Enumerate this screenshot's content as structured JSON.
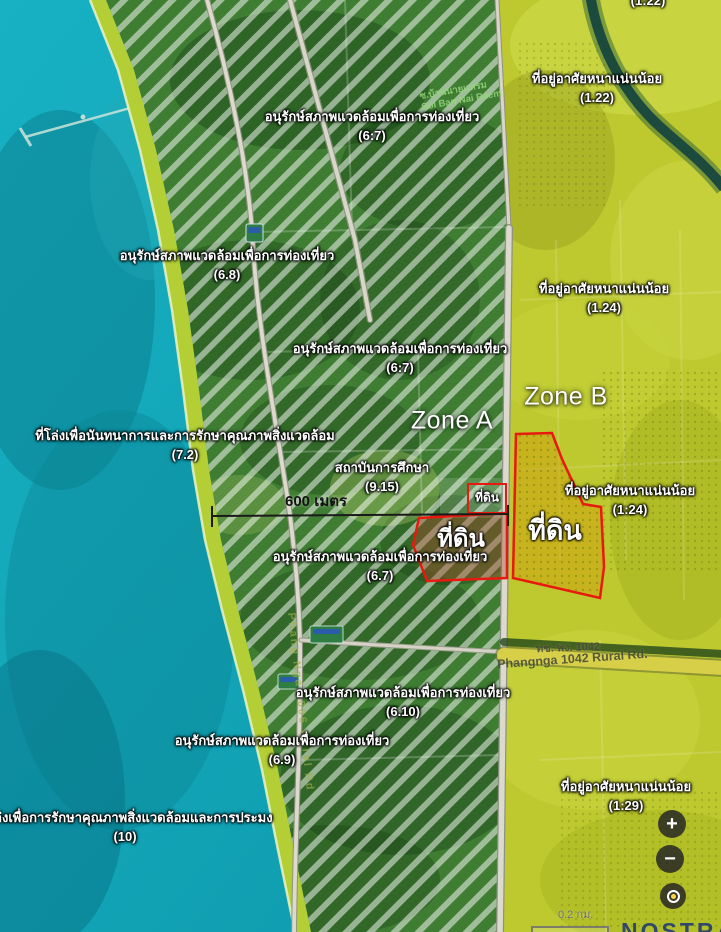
{
  "map": {
    "title_zone_a": "Zone A",
    "title_zone_b": "Zone B",
    "plot_label": "ที่ดิน",
    "measurement_label": "600 เมตร",
    "zoning_labels": [
      {
        "name": "อนุรักษ์สภาพแวดล้อมเพื่อการท่องเที่ยว",
        "code": "(6:7)"
      },
      {
        "name": "อนุรักษ์สภาพแวดล้อมเพื่อการท่องเที่ยว",
        "code": "(6.8)"
      },
      {
        "name": "อนุรักษ์สภาพแวดล้อมเพื่อการท่องเที่ยว",
        "code": "(6:7)"
      },
      {
        "name": "ที่โล่งเพื่อนันทนาการและการรักษาคุณภาพสิ่งแวดล้อม",
        "code": "(7.2)"
      },
      {
        "name": "สถาบันการศึกษา",
        "code": "(9.15)"
      },
      {
        "name": "อนุรักษ์สภาพแวดล้อมเพื่อการท่องเที่ยว",
        "code": "(6.7)"
      },
      {
        "name": "อนุรักษ์สภาพแวดล้อมเพื่อการท่องเที่ยว",
        "code": "(6.10)"
      },
      {
        "name": "อนุรักษ์สภาพแวดล้อมเพื่อการท่องเที่ยว",
        "code": "(6.9)"
      },
      {
        "name": "ล่งเพื่อการรักษาคุณภาพสิ่งแวดล้อมและการประมง",
        "code": "(10)"
      },
      {
        "name": "ที่อยู่อาศัยหนาแน่นน้อย",
        "code": "(1.22)"
      },
      {
        "name": "ที่อยู่อาศัยหนาแน่นน้อย",
        "code": "(1.24)"
      },
      {
        "name": "ที่อยู่อาศัยหนาแน่นน้อย",
        "code": "(1:24)"
      },
      {
        "name": "ที่อยู่อาศัยหนาแน่นน้อย",
        "code": "(1:29)"
      },
      {
        "name": "",
        "code": "(1:22)"
      }
    ],
    "road_labels": {
      "rural_1042_th": "ทช. พง. 1042",
      "rural_1042_en": "Phangnga 1042 Rural Rd.",
      "rural_3006_en": "Phang Nga 3006 Rural Rd"
    },
    "poi_labels": {
      "village_th": "ซ.บ้านนายแหรม",
      "village_en": "Soi Ban Nai Raem"
    },
    "controls": {
      "zoom_in": "+",
      "zoom_out": "−"
    },
    "scale_text": "0.2 กม.",
    "brand": "NOSTRA",
    "colors": {
      "sea": "#12a6b8",
      "conservation_green": "#3f7d33",
      "residential_yellow": "#bdc92e",
      "beach": "#b4cf35",
      "plot_outline": "#e8190f"
    }
  }
}
